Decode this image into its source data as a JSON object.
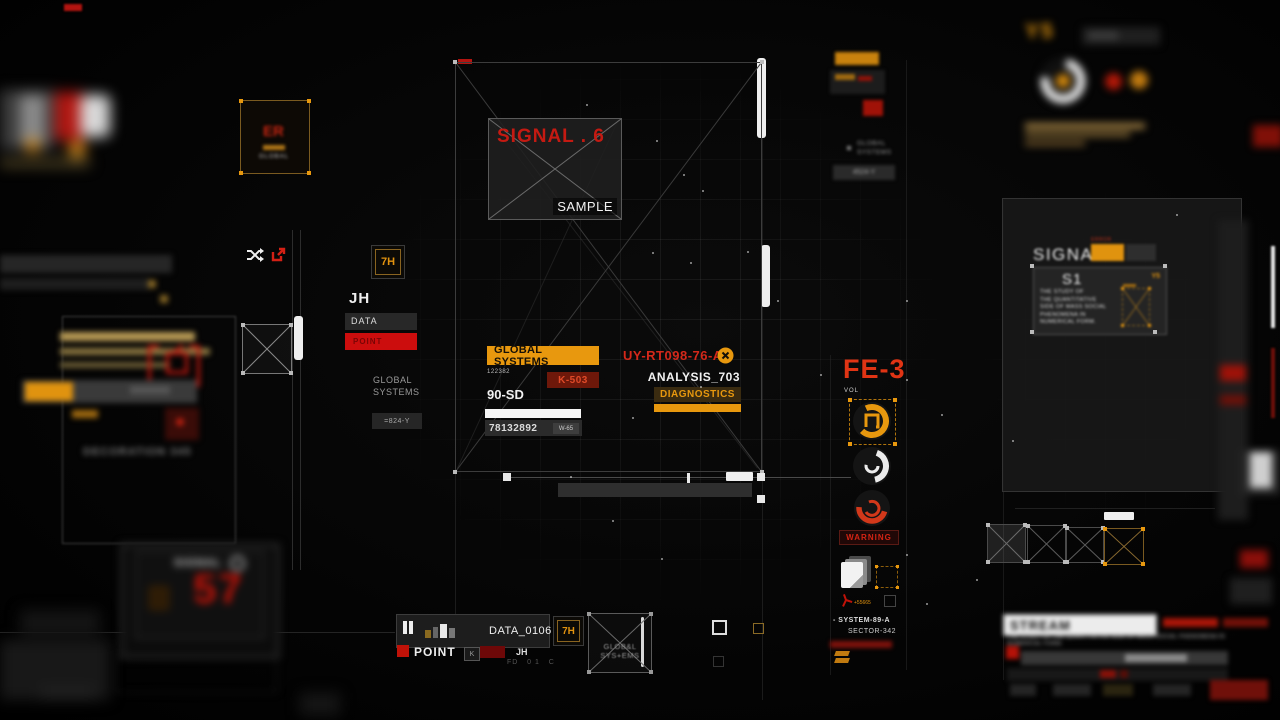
{
  "colors": {
    "orange": "#E8980E",
    "red": "#D2281A",
    "dark_red": "#7E0F0A"
  },
  "top_left": {
    "er_title": "ER",
    "er_sub": "GLOBAL"
  },
  "top_right": {
    "y5": "Y5"
  },
  "upper_right": {
    "global_line1": "GLOBAL",
    "global_line2": "SYSTEMS",
    "code": "4524-Y"
  },
  "left_cluster": {
    "badge": "7H",
    "initials": "JH",
    "data_label": "DATA",
    "point_label": "POINT",
    "global_line1": "GLOBAL",
    "global_line2": "SYSTEMS",
    "code": "=824-Y"
  },
  "left_blur": {
    "caption": "DECORATION 345"
  },
  "signal_box": {
    "title": "SIGNAL . 6",
    "sample": "SAMPLE"
  },
  "main_cluster": {
    "global_systems": "GLOBAL SYSTEMS",
    "code": "UY-RT098-76-A",
    "serial": "122382",
    "k_code": "K-503",
    "analysis": "ANALYSIS_703",
    "sd_code": "90-SD",
    "diagnostics": "DIAGNOSTICS",
    "number": "78132892",
    "w_code": "W-65"
  },
  "fe3": {
    "title": "FE-3",
    "vol": "VOL",
    "warning": "WARNING",
    "plus_code": "+55665",
    "system": "- SYSTEM-89-A",
    "sector": "SECTOR-342"
  },
  "right_panel": {
    "signal": "SIGNAL",
    "error": "ERROR",
    "s1": "S1",
    "y5": "Y5",
    "desc_lines": [
      "THE STUDY OF",
      "THE QUANTITATIVE",
      "SIDE OF MASS SOCIAL",
      "PHENOMENA IN",
      "NUMERICAL FORM."
    ]
  },
  "monitor": {
    "label": "SIGNAL",
    "value": "57"
  },
  "player": {
    "file": "DATA_0106",
    "badge": "7H",
    "point": "POINT",
    "k": "K",
    "initials": "JH",
    "faint": "FD   0 1   C",
    "glitch_line1": "GLOB&L",
    "glitch_line2": "SYS+EMS"
  },
  "stream": {
    "title": "STREAM",
    "description": "THE STUDY OF THE QUANTITATIVE SIDE OF MASS SOCIAL PHENOMENA IN NUMERICAL FORM."
  }
}
